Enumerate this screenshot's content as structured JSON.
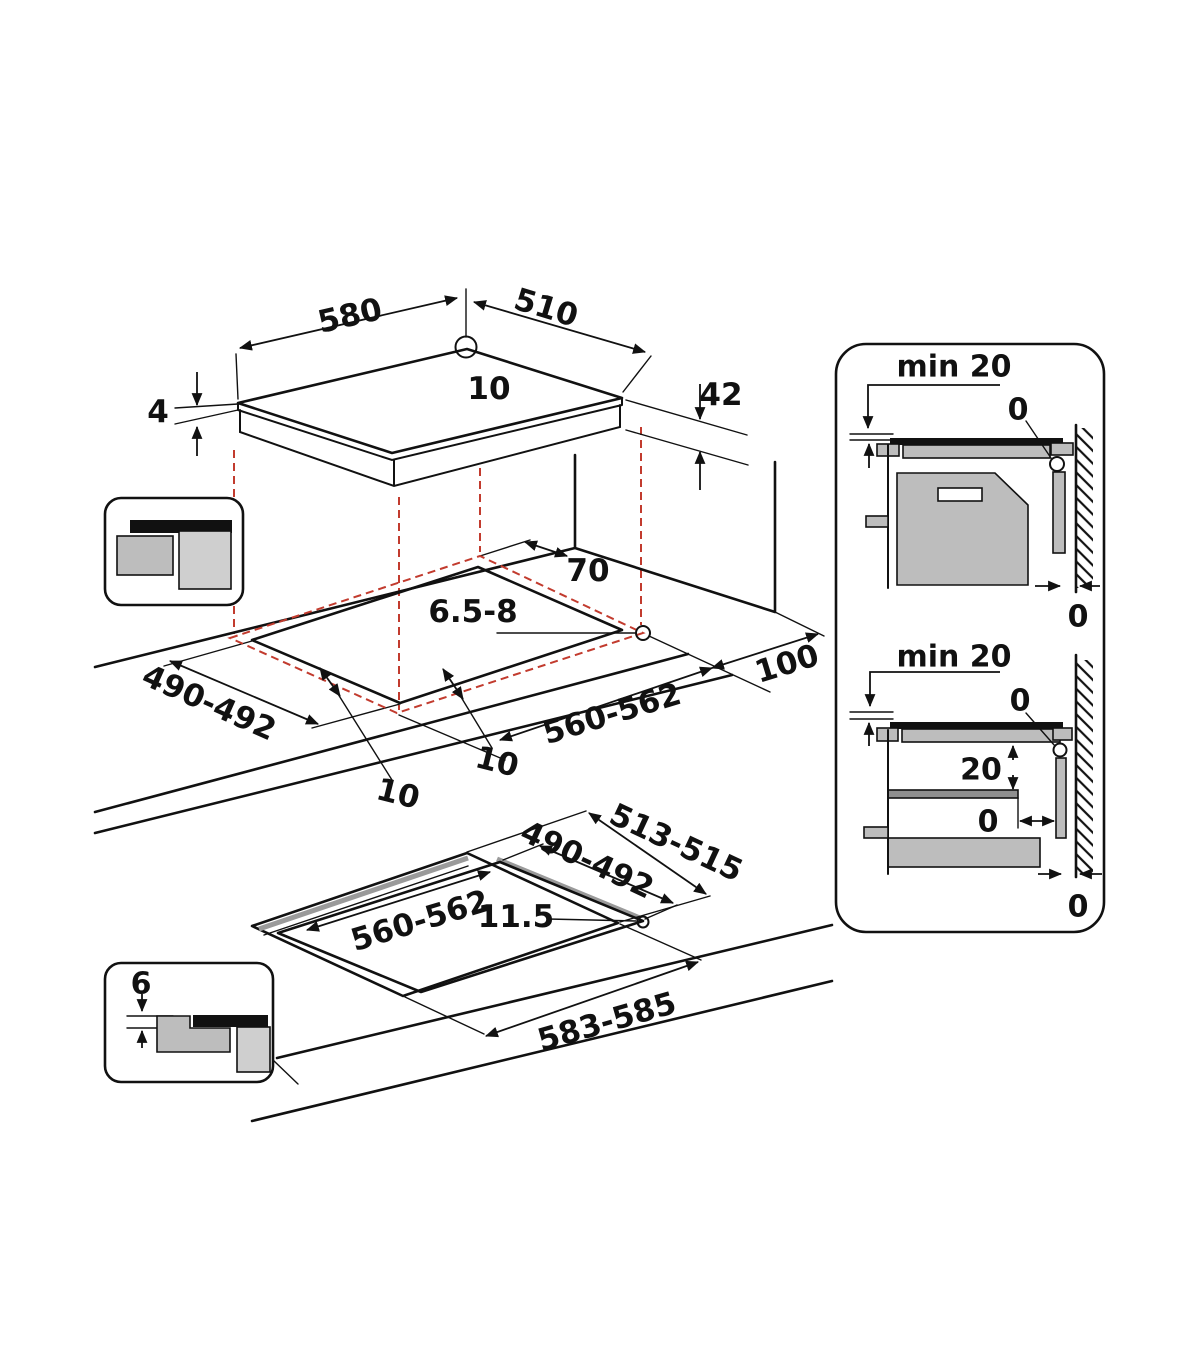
{
  "colors": {
    "line": "#111111",
    "red_dash": "#c23b2e",
    "gray_mid": "#bdbdbd",
    "gray_light": "#cfcfcf"
  },
  "top_view": {
    "width": "580",
    "depth": "510",
    "hole_diameter": "10",
    "glass_thickness": "4",
    "body_height": "42"
  },
  "worktop_view": {
    "rear_clearance": "70",
    "fix_holes": "6.5-8",
    "side_clearance": "100",
    "cutout_depth": "490-492",
    "cutout_width": "560-562",
    "gap_side": "10",
    "gap_front": "10"
  },
  "flush_view": {
    "recess_depth": "513-515",
    "cutout_depth": "490-492",
    "cutout_width": "560-562",
    "ledge_width": "11.5",
    "recess_width": "583-585"
  },
  "flush_inset": {
    "recess_step": "6"
  },
  "panel_top": {
    "min_clearance": "min 20",
    "wall_gap": "0",
    "rear_gap": "0"
  },
  "panel_bottom": {
    "min_clearance": "min 20",
    "wall_gap": "0",
    "shelf_clearance": "20",
    "shelf_gap": "0",
    "rear_gap": "0"
  }
}
